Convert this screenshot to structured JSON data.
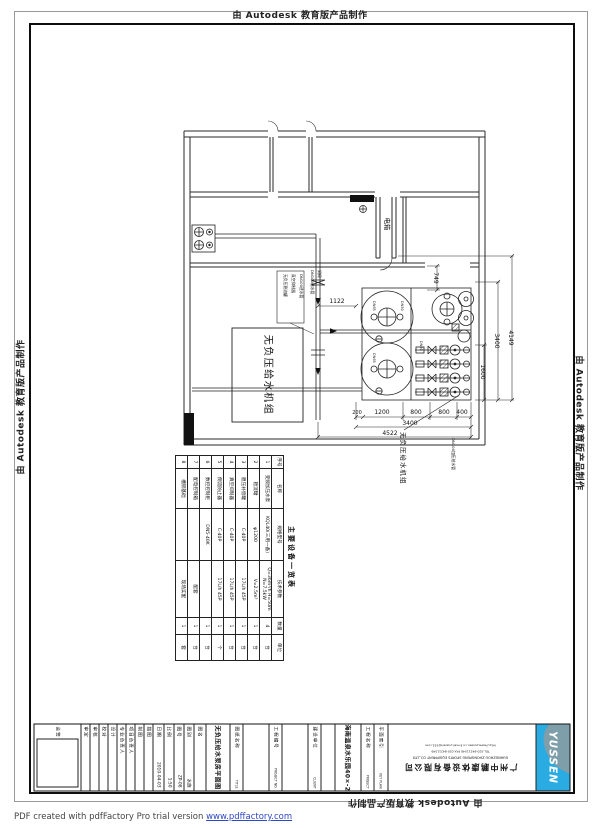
{
  "banner": {
    "text": "由 Autodesk 教育版产品制作"
  },
  "footer": {
    "text": "PDF created with pdfFactory Pro trial version ",
    "link": "www.pdffactory.com"
  },
  "plan": {
    "labels": {
      "electrical": "电箱",
      "unit_box": "无负压给水机组",
      "unit_leader": "无负压给水机组",
      "pipe_note": "DN100加压给水管"
    },
    "notes": [
      "无负压稳流罐",
      "真空抑制器",
      "DN100进水管"
    ],
    "notes2": [
      "DN100给水管",
      "闸阀"
    ],
    "ports": [
      "DN65",
      "DN50",
      "DN65",
      "DN50"
    ],
    "dims": {
      "h1122": "1122",
      "v749": "749",
      "v4149": "4149",
      "v3400": "3400",
      "v1600": "1600",
      "bottom_segments": [
        "200",
        "1200",
        "800",
        "800",
        "400"
      ],
      "bottom_3400": "3400",
      "bottom_4522": "4522"
    }
  },
  "equipment_table": {
    "title": "主要设备一览表",
    "headers": [
      "序号",
      "名称",
      "规格型号",
      "技术参数",
      "数量",
      "单位"
    ],
    "col_widths": [
      13,
      40,
      52,
      57,
      17,
      26
    ],
    "rows": [
      [
        "1",
        "变频加压水泵",
        "KQL40(三用一备)",
        "Q=36m³/h H=50m N=7.5kW",
        "4",
        "台"
      ],
      [
        "2",
        "稳流罐",
        "φ1200",
        "V=2.5m³",
        "1",
        "台"
      ],
      [
        "3",
        "稳压补偿罐",
        "C-40P",
        "17L/h 45P",
        "1",
        "台"
      ],
      [
        "4",
        "真空抑制器",
        "C-40P",
        "17L/h 45P",
        "1",
        "台"
      ],
      [
        "5",
        "倒流防止器",
        "C-40P",
        "17L/h 45P",
        "1",
        "个"
      ],
      [
        "6",
        "数控控制柜",
        "DN5-40K",
        "",
        "1",
        "台"
      ],
      [
        "7",
        "配电控制箱",
        "",
        "配套",
        "1",
        "台"
      ],
      [
        "8",
        "槽钢基础",
        "",
        "现场实配",
        "1",
        "套"
      ]
    ]
  },
  "titleblock": {
    "cells": [
      {
        "type": "sign",
        "label": "会签",
        "w": 46
      },
      {
        "type": "narrow",
        "label": "审定",
        "w": 9
      },
      {
        "type": "narrow",
        "label": "审核",
        "w": 9
      },
      {
        "type": "narrow",
        "label": "校对",
        "w": 9
      },
      {
        "type": "narrow",
        "label": "设计",
        "w": 9
      },
      {
        "type": "narrow",
        "label": "专业负责人",
        "w": 9
      },
      {
        "type": "narrow",
        "label": "项目负责人",
        "w": 9
      },
      {
        "type": "narrow",
        "label": "制图",
        "w": 9
      },
      {
        "type": "narrow",
        "label": "描图",
        "w": 9
      },
      {
        "type": "value",
        "label": "日期",
        "value": "2010-04-03",
        "w": 11
      },
      {
        "type": "value",
        "label": "比例",
        "value": "1:50",
        "w": 10
      },
      {
        "type": "value",
        "label": "图号",
        "value": "ZP-08",
        "w": 10
      },
      {
        "type": "value",
        "label": "图别",
        "value": "水施",
        "w": 10
      },
      {
        "type": "narrow",
        "label": "图名",
        "w": 12
      },
      {
        "type": "big",
        "value": "无负压给水泵房平面图",
        "w": 24
      },
      {
        "type": "caption",
        "label": "图纸名称",
        "en": "TITLE",
        "w": 13
      },
      {
        "type": "empty",
        "w": 26
      },
      {
        "type": "caption",
        "label": "工程编号",
        "en": "PROJECT NO.",
        "w": 13
      },
      {
        "type": "empty",
        "w": 26
      },
      {
        "type": "caption",
        "label": "建设单位",
        "en": "CLIENT",
        "w": 13
      },
      {
        "type": "empty",
        "w": 14
      },
      {
        "type": "big",
        "value": "海南温泉水乐园40×-20游泳池",
        "w": 26
      },
      {
        "type": "caption",
        "label": "工程名称",
        "en": "PROJECT",
        "w": 13
      },
      {
        "type": "caption",
        "label": "平面索引",
        "en": "KEY PLAN",
        "w": 14
      },
      {
        "type": "contact",
        "w": 0
      },
      {
        "type": "logo",
        "w": 34
      }
    ],
    "contact": {
      "company_cn": "广州中鹏康体设备有限公司",
      "company_en": "GUANGZHOU ZHONGPENG SPORTS EQUIPMENT CO.,LTD",
      "line1": "TEL:020-84211548  FAX:020-84211549",
      "line2": "http://www.yussen.cn   E-mail:yussen@163.com"
    },
    "logo_text": "YUSSEN"
  }
}
